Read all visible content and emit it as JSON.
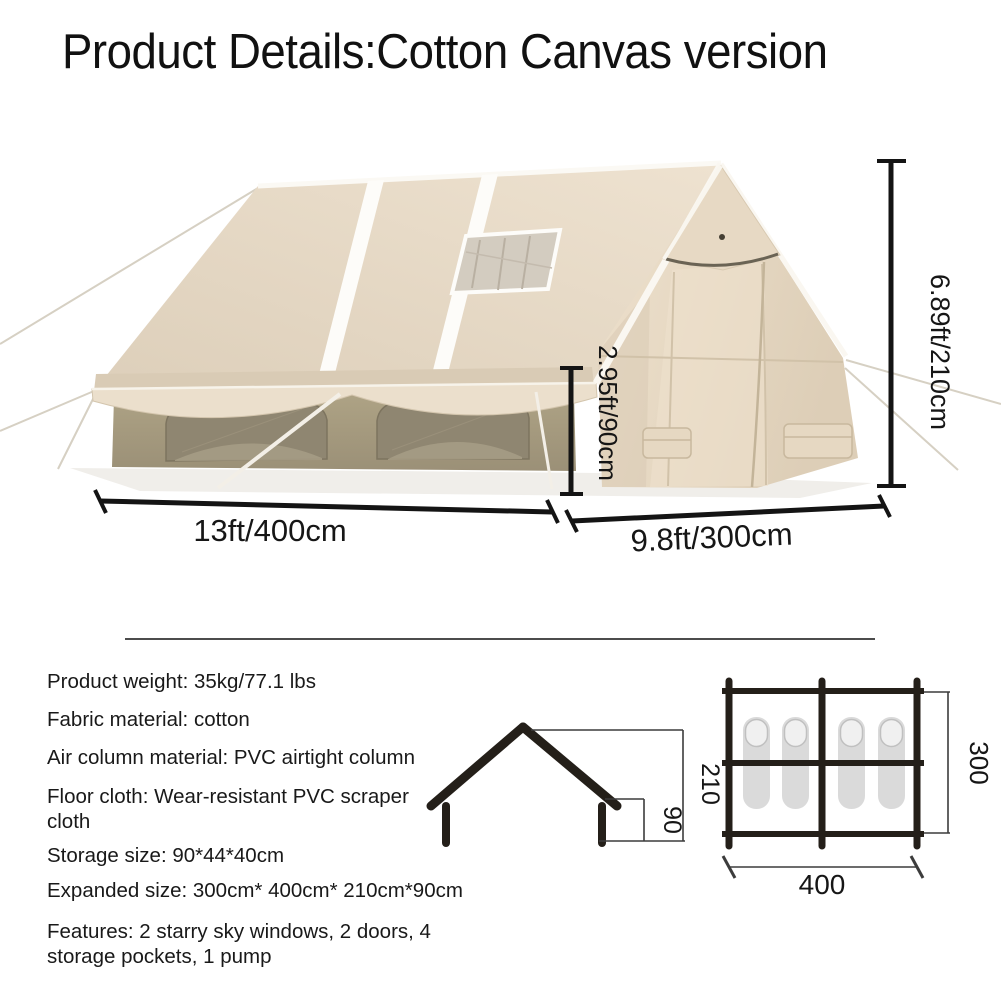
{
  "title": "Product Details:Cotton Canvas version",
  "photo": {
    "height_label": "6.89ft/210cm",
    "wall_height_label": "2.95ft/90cm",
    "length_label": "13ft/400cm",
    "depth_label": "9.8ft/300cm"
  },
  "specs": [
    {
      "text": "Product weight: 35kg/77.1 lbs"
    },
    {
      "text": "Fabric material: cotton"
    },
    {
      "text": "Air column material: PVC airtight column"
    },
    {
      "text": "Floor cloth: Wear-resistant PVC scraper cloth"
    },
    {
      "text": "Storage size: 90*44*40cm"
    },
    {
      "text": "Expanded size: 300cm* 400cm* 210cm*90cm"
    },
    {
      "text": "Features: 2 starry sky windows, 2 doors, 4 storage pockets, 1 pump"
    }
  ],
  "profile_diagram": {
    "height_label": "210",
    "wall_height_label": "90"
  },
  "floorplan_diagram": {
    "depth_label": "300",
    "length_label": "400"
  },
  "colors": {
    "canvas_light": "#ecdfcb",
    "canvas_shadow": "#d9cbb5",
    "wall": "#a89d83",
    "window": "#8f8671",
    "dimension_line": "#141414"
  }
}
